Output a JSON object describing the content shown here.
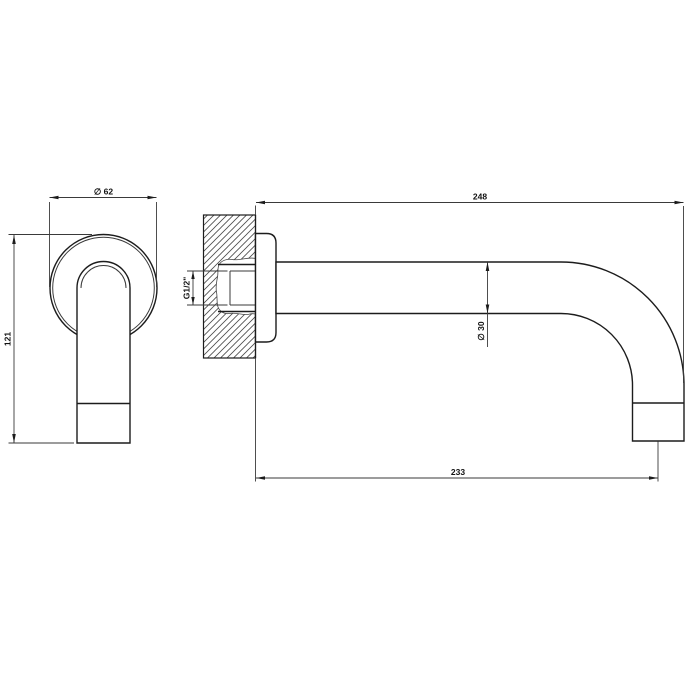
{
  "drawing": {
    "kind": "technical-drawing-wall-mounted-spout",
    "background": "#ffffff",
    "line_color": "#1c1c1c",
    "dim_line_color": "#3a3a3a",
    "text_color": "#111111",
    "front_view": {
      "dim_flange_diameter": "∅ 62",
      "dim_height": "121"
    },
    "side_view": {
      "dim_projection": "248",
      "dim_thread": "G1/2\"",
      "dim_spout_diameter": "∅ 30",
      "dim_reach_to_axis": "233"
    }
  }
}
